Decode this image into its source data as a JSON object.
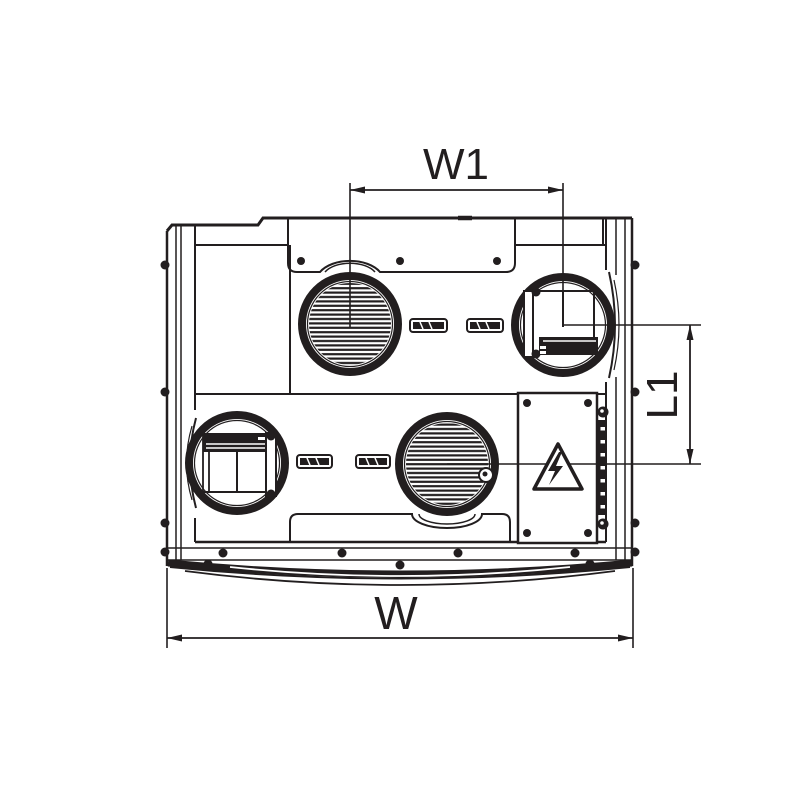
{
  "diagram": {
    "type": "technical-drawing",
    "subject": "ventilation unit top view with dimension callouts",
    "labels": {
      "w1": "W1",
      "l1": "L1",
      "w": "W"
    },
    "colors": {
      "ink": "#221e1f",
      "background": "#ffffff"
    },
    "icons": [
      {
        "name": "high-voltage-warning-icon",
        "meaning": "electrical hazard triangle with lightning bolt"
      }
    ],
    "features": {
      "ports": [
        "top-left grille",
        "top-right damper",
        "bottom-left damper",
        "bottom-right grille"
      ],
      "panels": [
        "top access panel",
        "bottom access panel",
        "electrical box",
        "terminal strip"
      ]
    }
  }
}
